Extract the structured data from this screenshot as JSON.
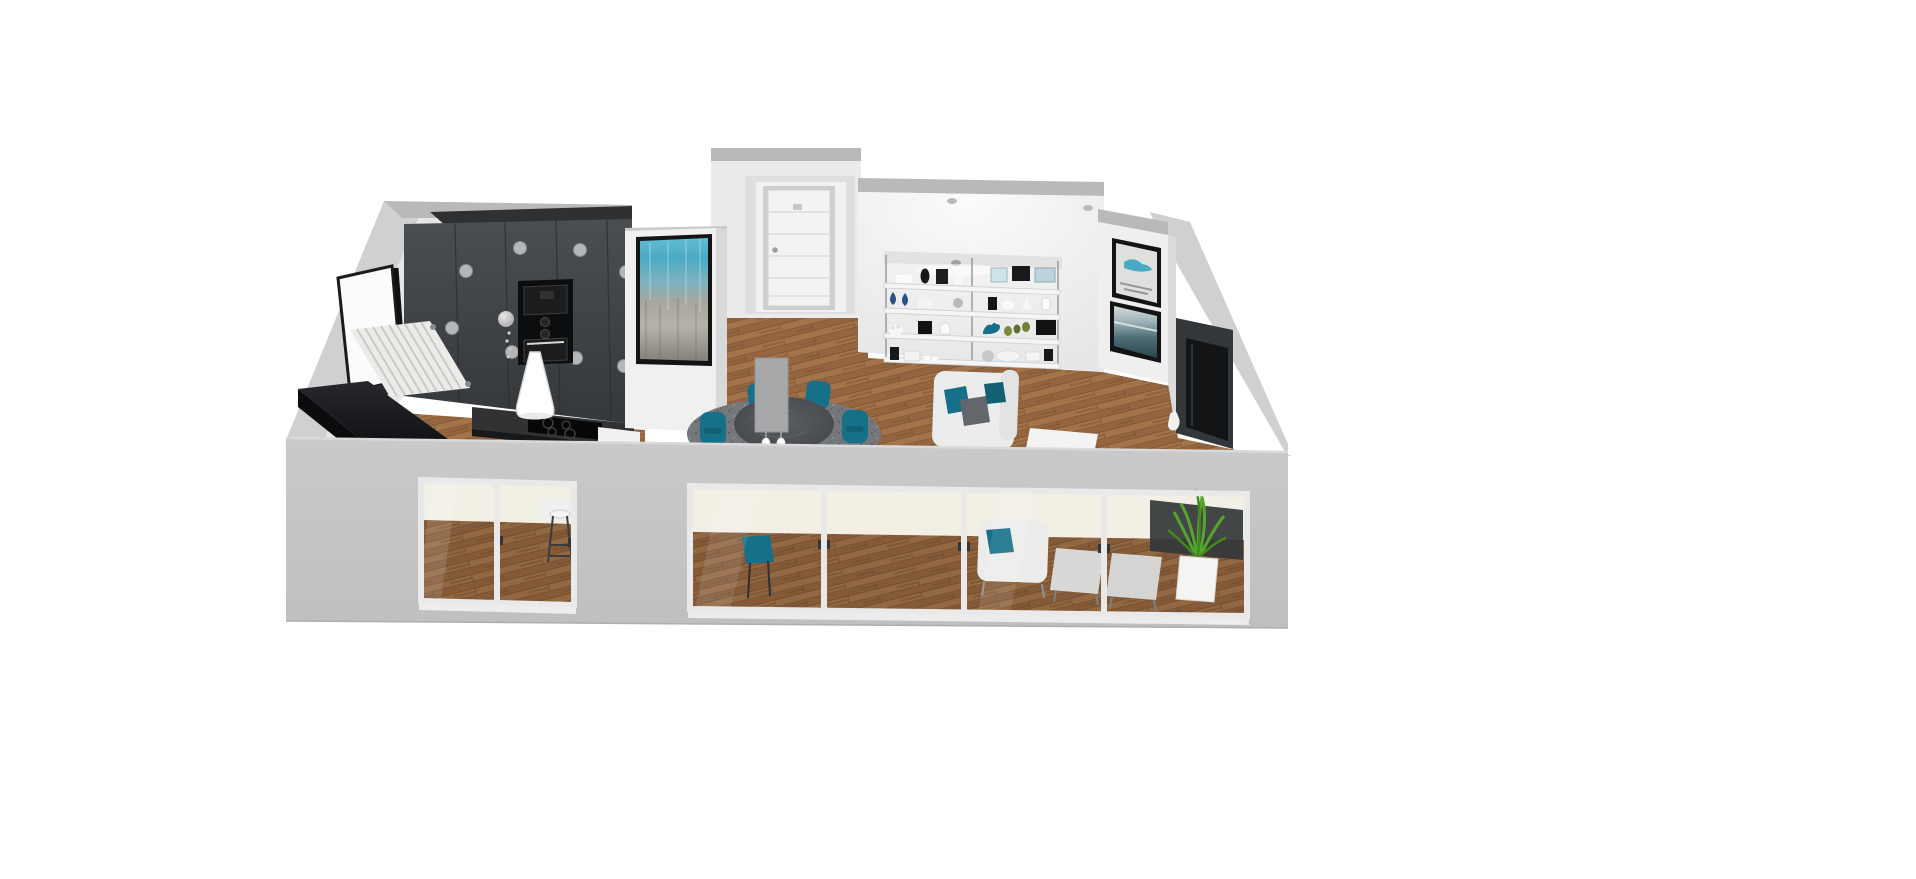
{
  "scene": {
    "label": "3D floor plan render of an open-plan apartment in elevated three-quarter view on a white background",
    "view": "elevated-three-quarter",
    "background": "#ffffff"
  },
  "colors": {
    "bg": "#ffffff",
    "wall_outer": "#c6c6c8",
    "wall_outer_light": "#d0d0d2",
    "wall_band": "#b9b9bb",
    "wall_inner": "#ececed",
    "wall_bright": "#f6f6f7",
    "charcoal": "#3f4245",
    "charcoal_dark": "#2e3032",
    "black_gloss": "#121316",
    "oven_black": "#0c0d0f",
    "wood": "#9a6a40",
    "wood_dark": "#7e5532",
    "wood_light": "#a3744a",
    "teal": "#16708a",
    "teal_deep": "#135f74",
    "art_teal": "#49aac3",
    "navy": "#27508a",
    "rug": "#74787c",
    "table_gray": "#474b4f",
    "sofa": "#ebecec",
    "pillow_gray": "#63666a",
    "shelf": "#f5f5f6",
    "door": "#f3f3f4",
    "frame": "#141414",
    "plant": "#55a52c",
    "plant_dark": "#3f8a1f",
    "pendant": "#ffffff",
    "transom": "#f2efe5",
    "glass_frame": "#e9e9e9",
    "panel_gray": "#a7a8aa",
    "media_dark": "#33373a",
    "tv": "#121416"
  },
  "zones": [
    {
      "name": "kitchen",
      "features": [
        "charcoal full-height cabinet wall",
        "built-in double oven tower",
        "island with black cooktop",
        "white cone pendant lamp",
        "sphere wall lamp",
        "ceiling spotlights",
        "white slatted console table",
        "black corner counter",
        "window on left wall",
        "bar stool at counter"
      ]
    },
    {
      "name": "hallway",
      "features": [
        "recessed alcove",
        "white panelled interior door",
        "gray wall panel",
        "beaded pendant lights"
      ]
    },
    {
      "name": "dining-area",
      "features": [
        "round dark table",
        "teal dining chairs",
        "mottled gray rug"
      ]
    },
    {
      "name": "living-room",
      "features": [
        "white sofa with teal and gray cushions",
        "white coffee table",
        "double wall shelving unit",
        "white armchair with teal cushion",
        "two light gray ottomans",
        "dark media wall with TV",
        "potted green plant",
        "recessed floor spotlights"
      ]
    }
  ],
  "artworks": [
    {
      "location": "kitchen-partition",
      "style": "teal-over-gray abstract, black frame"
    },
    {
      "location": "right-partition-top",
      "style": "blue splash on white abstract, black frame"
    },
    {
      "location": "right-partition-bottom",
      "style": "dark teal seascape, black frame"
    }
  ],
  "shelving_unit": {
    "bays": 2,
    "shelves_per_bay": 4,
    "decor": [
      "blue teardrop vases",
      "navy blue bird figurine",
      "black vases and boxes",
      "white vases and bowls",
      "framed mini prints",
      "green succulents",
      "towel rolls",
      "gray spheres"
    ]
  },
  "front_facade": {
    "glass_panels": 6,
    "sliding_sections": 2,
    "transom_color_name": "warm white",
    "frame_material": "white aluminium",
    "gray_piers": 3
  },
  "counts": {
    "kitchen_ceiling_spotlights": 8,
    "pendant_bead_strings": 2,
    "dining_chairs_visible": 5,
    "floor_spotlights": 2,
    "ottomans": 2
  }
}
